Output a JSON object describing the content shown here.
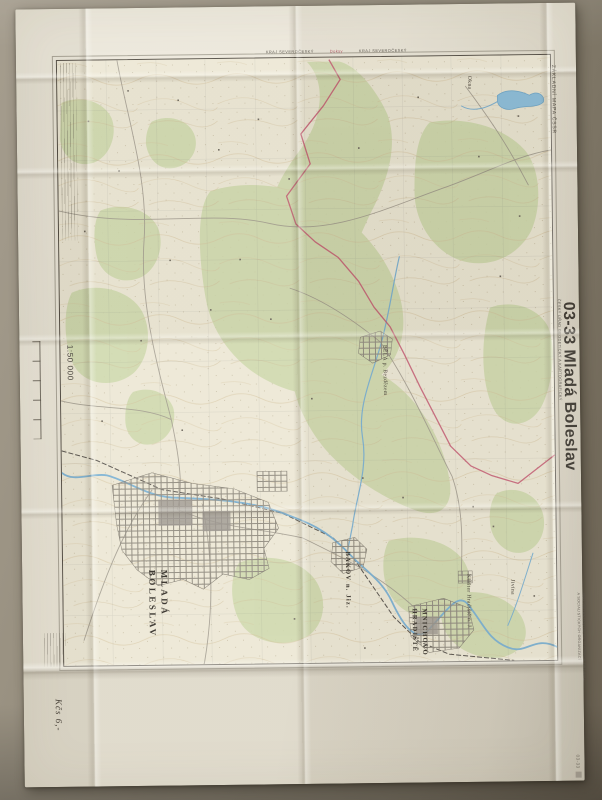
{
  "sheet": {
    "series_label": "ZÁKLADNÍ MAPA ČSSR",
    "agency": "ČESKÝ ÚŘAD GEODETICKÝ A KARTOGRAFICKÝ",
    "title": "03-33 Mladá Boleslav",
    "scale": "1:50 000",
    "restriction_line1": "PRO VNITŘNÍ POTŘEBU STÁTNÍCH ORGÁNŮ",
    "restriction_line2": "A SOCIALISTICKÝCH ORGANIZACÍ",
    "corner_stamp": "03-33",
    "handwritten_price": "Kčs 6,-",
    "top_margin": {
      "left_label": "KRAJ SEVEROČESKÝ",
      "sheet_ref": "Doksy",
      "right_label": "KRAJ SEVEROČESKÝ"
    }
  },
  "map": {
    "city": {
      "line1": "MLADÁ",
      "line2": "BOLESLAV"
    },
    "towns": [
      {
        "name": "BĚLÁ p. Bezdězem"
      },
      {
        "name": "BAKOV n. Jiz."
      },
      {
        "name": "MNICHOVO"
      },
      {
        "name": "HRADIŠTĚ"
      },
      {
        "name": "Klášter Hradiště n. J."
      },
      {
        "name": "Okna"
      },
      {
        "name": "Jivina"
      }
    ],
    "colors": {
      "paper": "#e9e4d5",
      "map_base": "#ece7d4",
      "forest_green": "#ccd7a8",
      "water_blue": "#76aed2",
      "kraj_boundary_red": "#c4556e",
      "contour_tan": "#d2bd95"
    }
  }
}
